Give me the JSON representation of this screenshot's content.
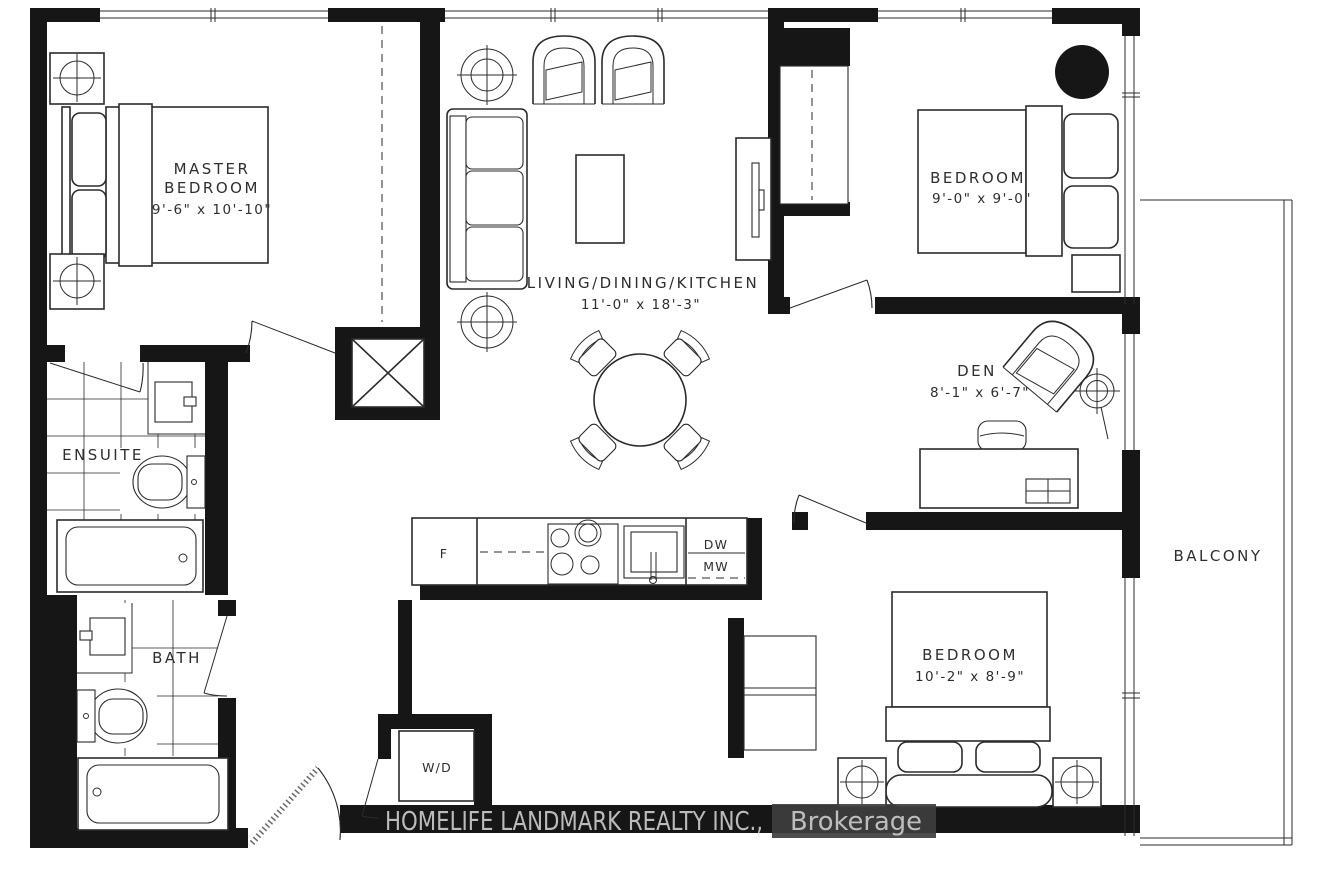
{
  "plan": {
    "watermark": {
      "line": "HOMELIFE LANDMARK REALTY INC.,",
      "suffix": "Brokerage"
    },
    "rooms": {
      "master_bedroom": {
        "name_line1": "MASTER",
        "name_line2": "BEDROOM",
        "dims": "9'-6\" x 10'-10\""
      },
      "living_dining_kitchen": {
        "name": "LIVING/DINING/KITCHEN",
        "dims": "11'-0\" x 18'-3\""
      },
      "bedroom_upper": {
        "name": "BEDROOM",
        "dims": "9'-0\" x 9'-0\""
      },
      "den": {
        "name": "DEN",
        "dims": "8'-1\" x 6'-7\""
      },
      "bedroom_lower": {
        "name": "BEDROOM",
        "dims": "10'-2\" x 8'-9\""
      },
      "ensuite": {
        "name": "ENSUITE"
      },
      "bath": {
        "name": "BATH"
      },
      "balcony": {
        "name": "BALCONY"
      }
    },
    "appliances": {
      "fridge": "F",
      "dishwasher": "DW",
      "microwave": "MW",
      "washer_dryer": "W/D"
    },
    "colors": {
      "wall": "#161616",
      "line": "#2b2b2b",
      "watermark_text": "#c9c9c9",
      "watermark_badge": "#3e3e3e"
    }
  }
}
